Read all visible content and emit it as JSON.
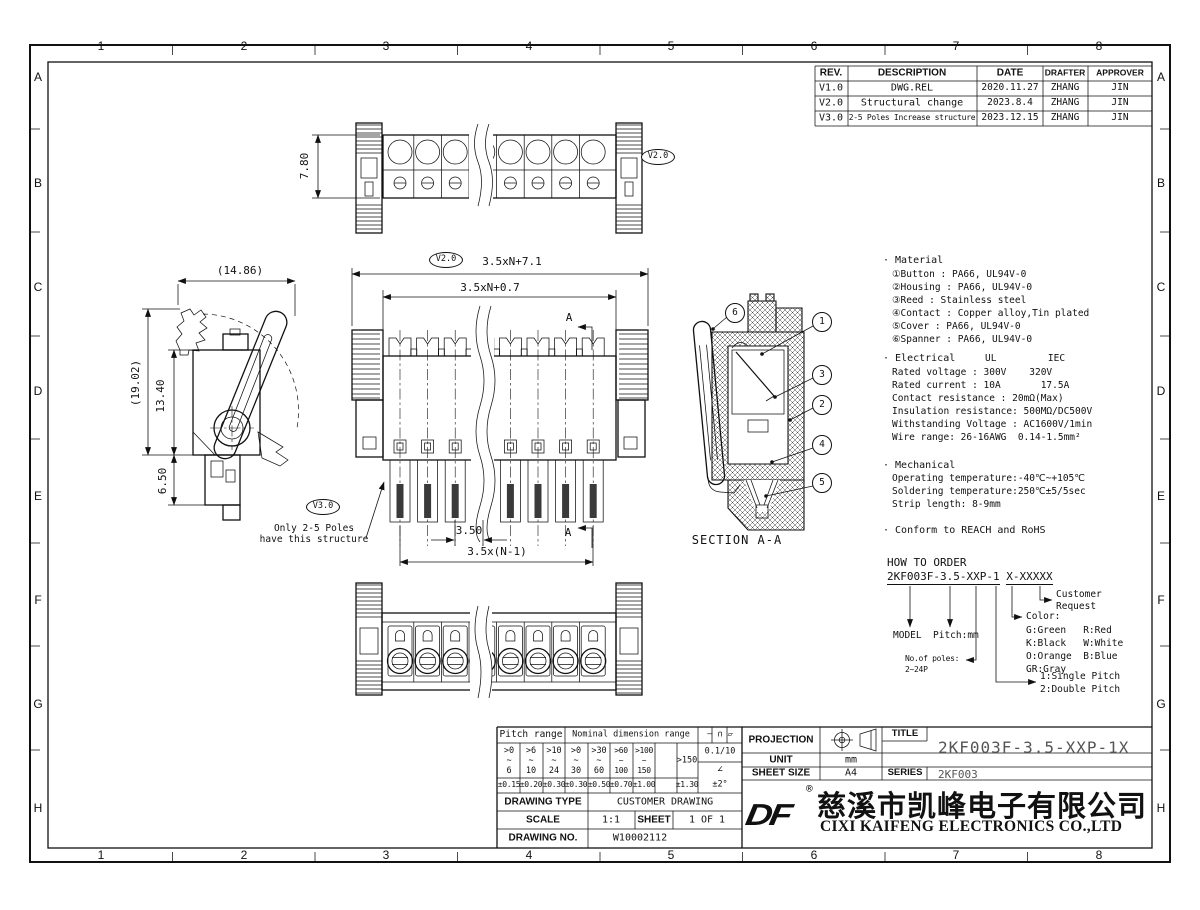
{
  "sheet": {
    "zones_cols": [
      "1",
      "2",
      "3",
      "4",
      "5",
      "6",
      "7",
      "8"
    ],
    "zones_rows": [
      "A",
      "B",
      "C",
      "D",
      "E",
      "F",
      "G",
      "H"
    ]
  },
  "revision_table": {
    "headers": [
      "REV.",
      "DESCRIPTION",
      "DATE",
      "DRAFTER",
      "APPROVER"
    ],
    "rows": [
      [
        "V1.0",
        "DWG.REL",
        "2020.11.27",
        "ZHANG",
        "JIN"
      ],
      [
        "V2.0",
        "Structural change",
        "2023.8.4",
        "ZHANG",
        "JIN"
      ],
      [
        "V3.0",
        "2-5 Poles Increase structure",
        "2023.12.15",
        "ZHANG",
        "JIN"
      ]
    ]
  },
  "notes": {
    "material_title": "· Material",
    "material_lines": "①Button : PA66, UL94V-0\n②Housing : PA66, UL94V-0\n③Reed : Stainless steel\n④Contact : Copper alloy,Tin plated\n⑤Cover : PA66, UL94V-0\n⑥Spanner : PA66, UL94V-0",
    "electrical_title": "· Electrical",
    "electrical_cols": "UL         IEC",
    "electrical_lines": "Rated voltage : 300V    320V\nRated current : 10A       17.5A\nContact resistance : 20mΩ(Max)\nInsulation resistance: 500MΩ/DC500V\nWithstanding Voltage : AC1600V/1min\nWire range: 26-16AWG  0.14-1.5mm²",
    "mechanical_title": "· Mechanical",
    "mechanical_lines": "Operating temperature:-40℃~+105℃\nSoldering temperature:250℃±5/5sec\nStrip length: 8-9mm",
    "conform": "· Conform to REACH and RoHS"
  },
  "order": {
    "title": "HOW TO ORDER",
    "code_main": "2KF003F-3.5-XXP-1",
    "code_suffix": "X-XXXXX",
    "model": "MODEL",
    "pitch": "Pitch:mm",
    "poles": "No.of poles:\n2~24P",
    "color_title": "Color:",
    "color_rows": "G:Green   R:Red\nK:Black   W:White\nO:Orange  B:Blue\nGR:Gray",
    "pitch_opts": "1:Single Pitch\n2:Double Pitch",
    "customer": "Customer\nRequest"
  },
  "dims": {
    "top_height": "7.80",
    "front_total": "3.5xN+7.1",
    "front_inner": "3.5xN+0.7",
    "pitch": "3.50",
    "pitch_span": "3.5x(N-1)",
    "side_width": "(14.86)",
    "side_height": "(19.02)",
    "side_body": "13.40",
    "side_foot": "6.50",
    "section_label": "SECTION A-A",
    "section_a_top": "A",
    "section_a_bottom": "A",
    "note": "Only 2-5 Poles\nhave this structure",
    "v20_top": "V2.0",
    "v20_dim": "V2.0",
    "v30_note": "V3.0"
  },
  "balloons": {
    "b1": "1",
    "b2": "2",
    "b3": "3",
    "b4": "4",
    "b5": "5",
    "b6": "6"
  },
  "title_block": {
    "projection_label": "PROJECTION",
    "unit_label": "UNIT",
    "unit_value": "mm",
    "sheet_size_label": "SHEET SIZE",
    "sheet_size_value": "A4",
    "title_label": "TITLE",
    "title_value": "2KF003F-3.5-XXP-1X",
    "series_label": "SERIES",
    "series_value": "2KF003",
    "logo": "DF",
    "reg": "®",
    "company_cn": "慈溪市凯峰电子有限公司",
    "company_en": "CIXI KAIFENG ELECTRONICS CO.,LTD"
  },
  "tolerance_table": {
    "pitch_header": "Pitch range",
    "nominal_header": "Nominal dimension range",
    "symbols": "— ∩ ▱",
    "ranges": [
      ">0\n~\n6",
      ">6\n~\n10",
      ">10\n~\n24",
      ">0\n~\n30",
      ">30\n~\n60",
      ">60\n~\n100",
      ">100\n~\n150"
    ],
    "range_150": ">150",
    "ratio": "0.1/10",
    "angle_sym": "∠",
    "tols": [
      "±0.15",
      "±0.20",
      "±0.30",
      "±0.30",
      "±0.50",
      "±0.70",
      "±1.00",
      "±1.30",
      "±2°"
    ],
    "drawing_type_label": "DRAWING TYPE",
    "drawing_type": "CUSTOMER DRAWING",
    "scale_label": "SCALE",
    "scale": "1:1",
    "sheet_label": "SHEET",
    "sheet": "1 OF 1",
    "drawing_no_label": "DRAWING NO.",
    "drawing_no": "W10002112"
  }
}
